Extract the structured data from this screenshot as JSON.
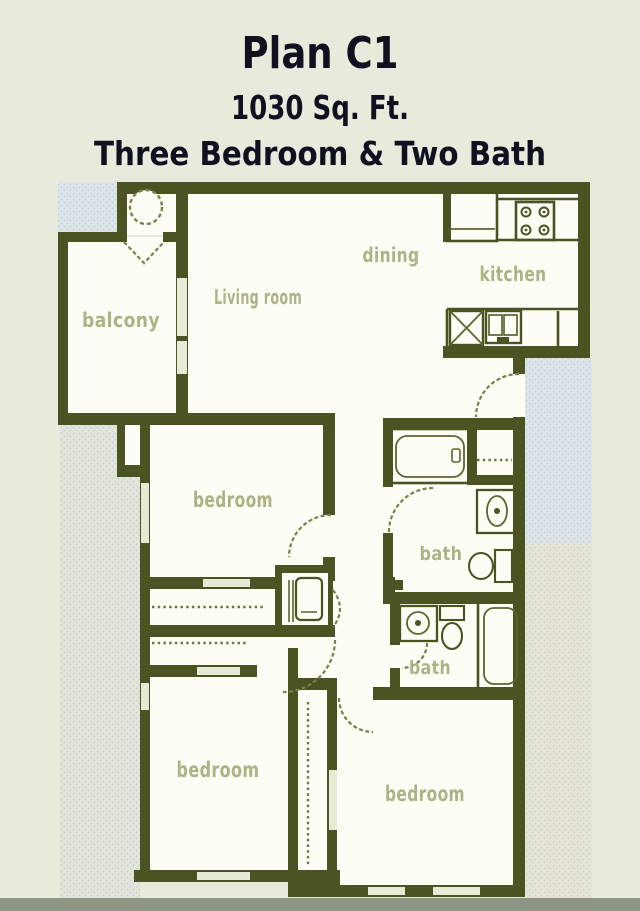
{
  "title": {
    "plan": "Plan C1",
    "area": "1030 Sq. Ft.",
    "config": "Three Bedroom & Two Bath"
  },
  "summary": {
    "plan_name": "Plan C1",
    "square_feet": "1030",
    "bedrooms": "Three",
    "bathrooms": "Two"
  },
  "rooms": {
    "balcony": "balcony",
    "living": "Living room",
    "dining": "dining",
    "kitchen": "kitchen",
    "bedroom1": "bedroom",
    "bedroom2": "bedroom",
    "bedroom3": "bedroom",
    "bath1": "bath",
    "bath2": "bath"
  },
  "fixtures": [
    "refrigerator",
    "stove-4-burner",
    "kitchen-counter",
    "dishwasher",
    "double-sink",
    "bathtub-horizontal",
    "bathtub-vertical",
    "vanity-sink-oval",
    "vanity-sink-round",
    "toilet",
    "toilet",
    "water-heater",
    "closet-rod",
    "closet-rod",
    "closet-rod",
    "linen-rod",
    "door-swing-front-entry",
    "door-swing-bedroom",
    "door-swing-bath",
    "window",
    "balcony-door-indicator"
  ],
  "colors": {
    "background": "#e8eadb",
    "walls": "#4b5322",
    "floor": "#fdfdf6",
    "room_labels": "#aeb284",
    "title_text": "#101020",
    "hatch_blue": "#dce6ea",
    "hatch_gray_green": "#e2e6dd",
    "hatch_cream": "#e6e4d6",
    "window_fill": "#e7ead4",
    "door_arc": "#79814b",
    "footer_bar": "#8e9685"
  }
}
